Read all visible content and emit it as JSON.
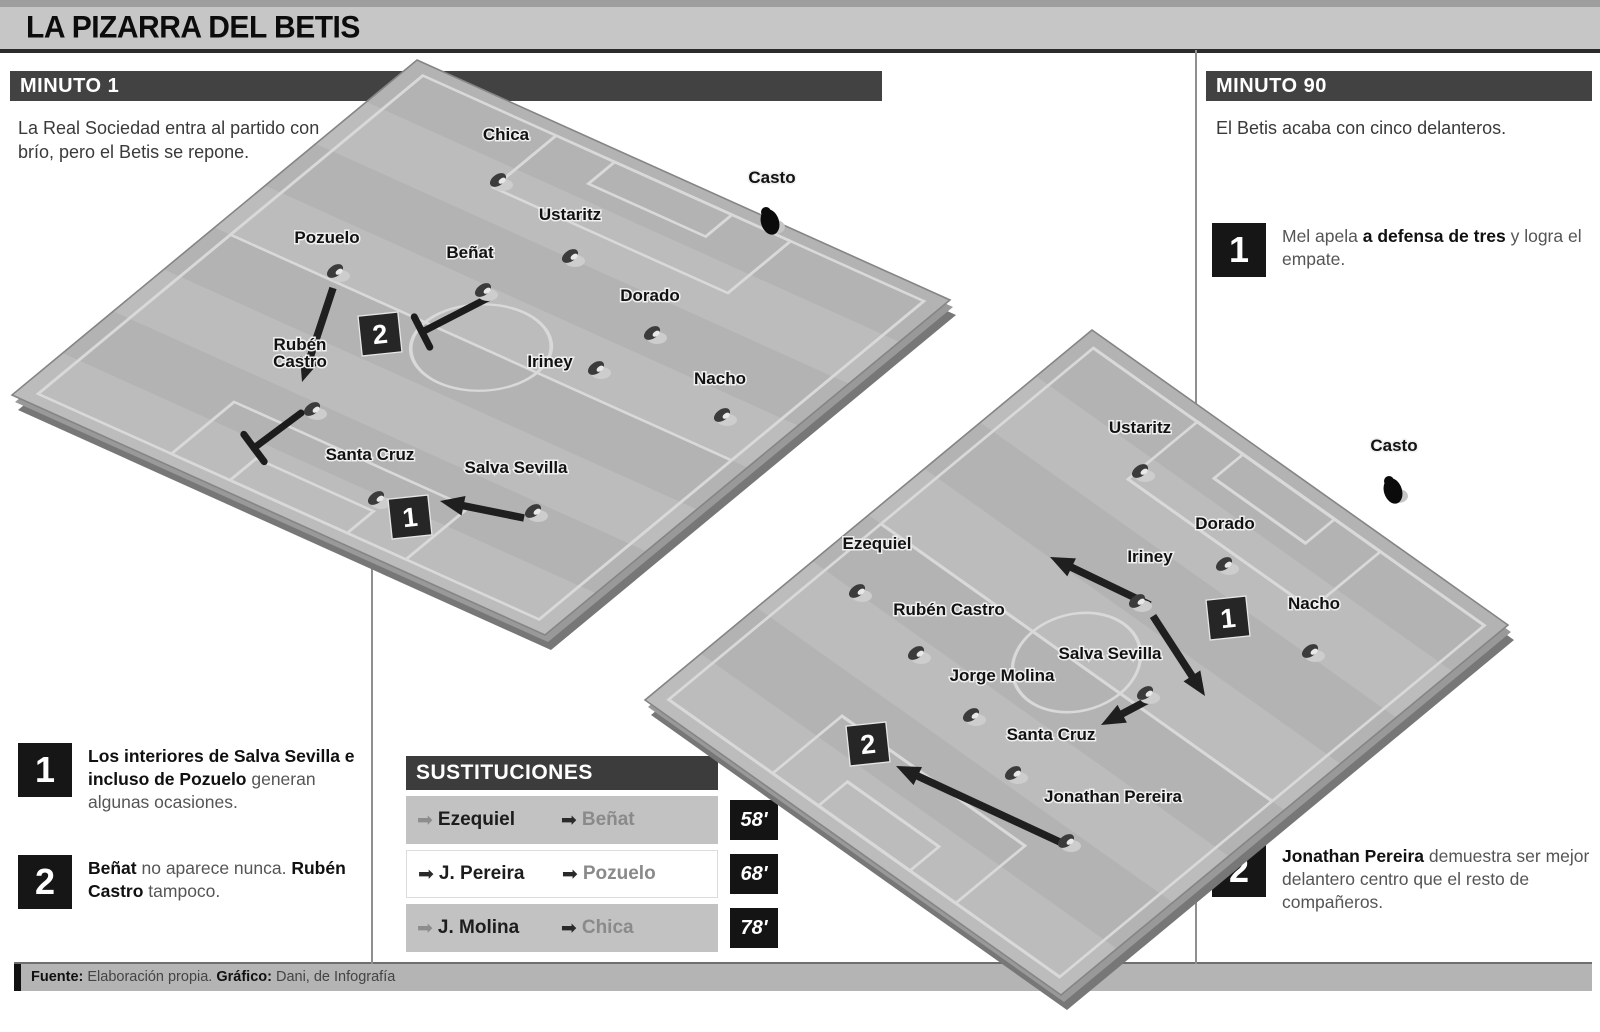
{
  "title": "LA PIZARRA DEL BETIS",
  "minuto1": {
    "header": "MINUTO 1",
    "intro": "La Real Sociedad entra al partido con brío, pero el Betis se repone.",
    "note1": {
      "num": "1",
      "segments": [
        [
          "b",
          "Los interiores de Salva Sevilla e incluso de Pozuelo"
        ],
        [
          "r",
          " generan algunas ocasiones."
        ]
      ]
    },
    "note2": {
      "num": "2",
      "segments": [
        [
          "b",
          "Beñat"
        ],
        [
          "r",
          " no aparece nunca. "
        ],
        [
          "b",
          "Rubén Castro"
        ],
        [
          "r",
          " tampoco."
        ]
      ]
    }
  },
  "minuto90": {
    "header": "MINUTO 90",
    "intro": "El Betis acaba con cinco delanteros.",
    "note1": {
      "num": "1",
      "segments": [
        [
          "r",
          "Mel apela "
        ],
        [
          "b",
          "a defensa de tres"
        ],
        [
          "r",
          " y logra el empate."
        ]
      ]
    },
    "note2": {
      "num": "2",
      "segments": [
        [
          "b",
          "Jonathan Pereira"
        ],
        [
          "r",
          " demuestra ser mejor delantero centro que el resto de compañeros."
        ]
      ]
    }
  },
  "substitutions": {
    "title": "SUSTITUCIONES",
    "rows": [
      {
        "out": "Ezequiel",
        "in": "Beñat",
        "minute": "58'"
      },
      {
        "out": "J. Pereira",
        "in": "Pozuelo",
        "minute": "68'"
      },
      {
        "out": "J. Molina",
        "in": "Chica",
        "minute": "78'"
      }
    ]
  },
  "footer": {
    "segments": [
      [
        "b",
        "Fuente:"
      ],
      [
        "r",
        " Elaboración propia. "
      ],
      [
        "b",
        "Gráfico:"
      ],
      [
        "r",
        " Dani, de Infografía"
      ]
    ]
  },
  "pitches": [
    {
      "name": "pitch-minute-1",
      "corners": [
        [
          417,
          60
        ],
        [
          950,
          300
        ],
        [
          545,
          635
        ],
        [
          12,
          395
        ]
      ],
      "players": [
        {
          "name": "Chica",
          "lx": 506,
          "ly": 140,
          "x": 498,
          "y": 180
        },
        {
          "name": "Casto",
          "lx": 772,
          "ly": 183,
          "x": 770,
          "y": 222,
          "gk": true
        },
        {
          "name": "Pozuelo",
          "lx": 327,
          "ly": 243,
          "x": 335,
          "y": 271
        },
        {
          "name": "Beñat",
          "lx": 470,
          "ly": 258,
          "x": 483,
          "y": 290
        },
        {
          "name": "Ustaritz",
          "lx": 570,
          "ly": 220,
          "x": 570,
          "y": 256
        },
        {
          "name": "Dorado",
          "lx": 650,
          "ly": 301,
          "x": 652,
          "y": 333
        },
        {
          "name": "Iriney",
          "lx": 550,
          "ly": 367,
          "x": 596,
          "y": 368
        },
        {
          "name": "Nacho",
          "lx": 720,
          "ly": 384,
          "x": 722,
          "y": 415
        },
        {
          "lines": [
            "Rubén",
            "Castro"
          ],
          "lx": 300,
          "ly": 350,
          "x": 312,
          "y": 409
        },
        {
          "name": "Santa Cruz",
          "lx": 370,
          "ly": 460,
          "x": 376,
          "y": 498
        },
        {
          "name": "Salva Sevilla",
          "lx": 516,
          "ly": 473,
          "x": 533,
          "y": 511
        }
      ],
      "badges": [
        {
          "n": "2",
          "x": 380,
          "y": 334
        },
        {
          "n": "1",
          "x": 410,
          "y": 517
        }
      ],
      "arrows": [
        {
          "x1": 333,
          "y1": 288,
          "x2": 302,
          "y2": 382
        },
        {
          "x1": 524,
          "y1": 518,
          "x2": 440,
          "y2": 501
        }
      ],
      "blocks": [
        {
          "x1": 490,
          "y1": 297,
          "x2": 422,
          "y2": 332
        },
        {
          "x1": 301,
          "y1": 413,
          "x2": 254,
          "y2": 448
        }
      ]
    },
    {
      "name": "pitch-minute-90",
      "corners": [
        [
          1092,
          330
        ],
        [
          1508,
          625
        ],
        [
          1061,
          995
        ],
        [
          645,
          700
        ]
      ],
      "players": [
        {
          "name": "Ustaritz",
          "lx": 1140,
          "ly": 433,
          "x": 1140,
          "y": 471
        },
        {
          "name": "Casto",
          "lx": 1394,
          "ly": 451,
          "x": 1393,
          "y": 491,
          "gk": true
        },
        {
          "name": "Dorado",
          "lx": 1225,
          "ly": 529,
          "x": 1224,
          "y": 564
        },
        {
          "name": "Iriney",
          "lx": 1150,
          "ly": 562,
          "x": 1137,
          "y": 601
        },
        {
          "name": "Nacho",
          "lx": 1314,
          "ly": 609,
          "x": 1310,
          "y": 651
        },
        {
          "name": "Ezequiel",
          "lx": 877,
          "ly": 549,
          "x": 857,
          "y": 591
        },
        {
          "name": "Rubén Castro",
          "lx": 949,
          "ly": 615,
          "x": 916,
          "y": 653
        },
        {
          "name": "Jorge Molina",
          "lx": 1002,
          "ly": 681,
          "x": 971,
          "y": 715
        },
        {
          "name": "Salva Sevilla",
          "lx": 1110,
          "ly": 659,
          "x": 1145,
          "y": 693
        },
        {
          "name": "Santa Cruz",
          "lx": 1051,
          "ly": 740,
          "x": 1013,
          "y": 773
        },
        {
          "name": "Jonathan Pereira",
          "lx": 1113,
          "ly": 802,
          "x": 1066,
          "y": 841
        }
      ],
      "badges": [
        {
          "n": "1",
          "x": 1228,
          "y": 618
        },
        {
          "n": "2",
          "x": 868,
          "y": 744
        }
      ],
      "arrows": [
        {
          "x1": 1150,
          "y1": 605,
          "x2": 1050,
          "y2": 557
        },
        {
          "x1": 1153,
          "y1": 616,
          "x2": 1205,
          "y2": 696
        },
        {
          "x1": 1152,
          "y1": 698,
          "x2": 1101,
          "y2": 725
        },
        {
          "x1": 1062,
          "y1": 843,
          "x2": 896,
          "y2": 766
        }
      ],
      "blocks": []
    }
  ]
}
